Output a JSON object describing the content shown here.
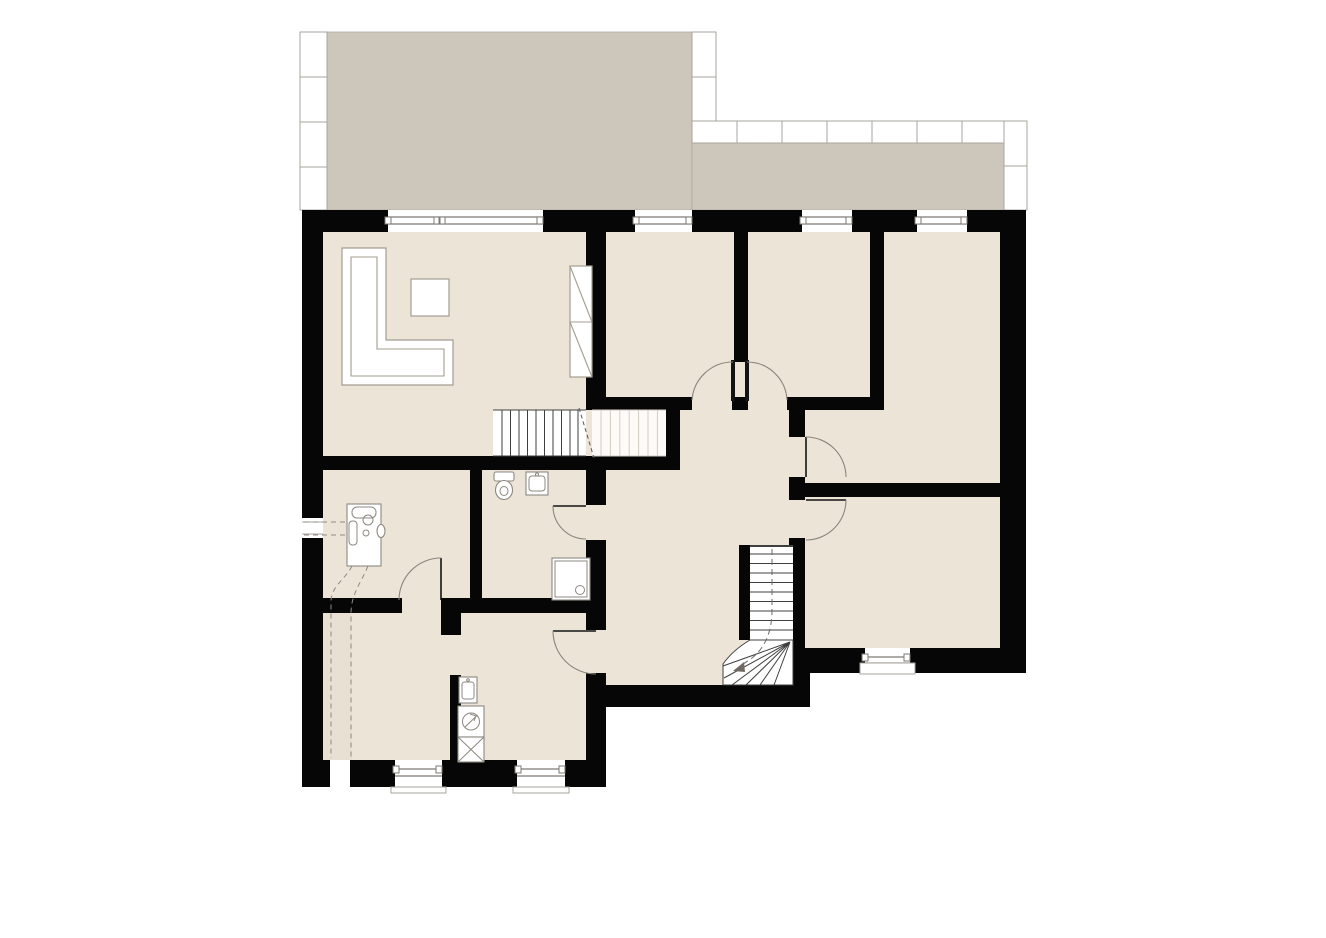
{
  "document": {
    "kind": "architectural-floor-plan",
    "visible_text": []
  },
  "colors": {
    "background": "#ffffff",
    "outside": "#ffffff",
    "wall": "#060606",
    "floor": "#ece4d7",
    "terrace": "#cdc6bb",
    "tile_fill": "#ffffff",
    "tile_line": "#a9a59d",
    "window_line": "#7d7973",
    "fixture_line": "#8d8880",
    "furniture_line": "#a39d92",
    "stair_line": "#3f3f3f",
    "stair_faint": "#d3cdc3",
    "dash_line": "#8f8b82",
    "door_arc": "#8a857c",
    "door_leaf": "#141414",
    "shade_strip": "#e7e0d3"
  },
  "areas": {
    "terrace": "terrace-with-tile-border",
    "living_area": "living-area",
    "bedroom_left": "bedroom-left",
    "bedroom_right": "bedroom-right",
    "room_right_top": "room-right-top",
    "room_right_bottom": "room-right-bottom",
    "hallway": "hallway",
    "bathroom": "bathroom",
    "utility_room": "utility-room",
    "storage_room": "storage-room",
    "kitchen_laundry": "kitchen-laundry"
  },
  "fixtures": [
    "l-shaped-sofa",
    "coffee-table",
    "wardrobe-cabinet",
    "toilet",
    "wash-basin",
    "shower-tray",
    "water-heater",
    "kitchen-sink",
    "washing-machine",
    "stove-hob",
    "upper-staircase",
    "lower-staircase-with-winders",
    "window-symbols",
    "door-swing-symbols",
    "service-conduit-dashed"
  ]
}
